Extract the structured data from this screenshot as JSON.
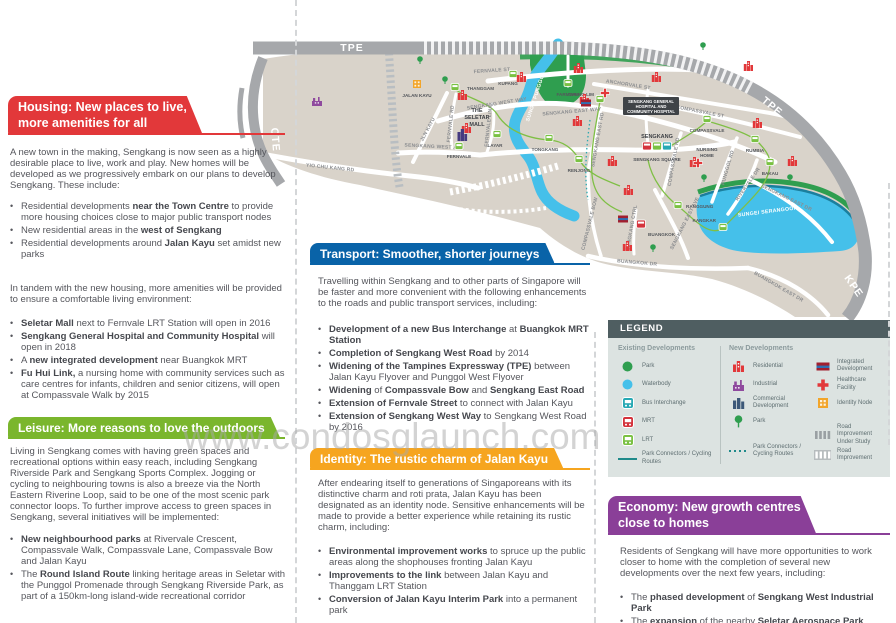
{
  "watermark": "www.condosglaunch.com",
  "sections": {
    "housing": {
      "title": "Housing: New places to live,\nmore amenities for all",
      "intro": "A new town in the making, Sengkang is now seen as a highly desirable place to live, work and play. New homes will be developed as we progressively embark on our plans to develop Sengkang. These include:",
      "bullets1": [
        [
          {
            "t": "Residential developments ",
            "b": false
          },
          {
            "t": "near the Town Centre",
            "b": true
          },
          {
            "t": " to provide more housing choices close to major public transport nodes",
            "b": false
          }
        ],
        [
          {
            "t": "New residential areas in the ",
            "b": false
          },
          {
            "t": "west of Sengkang",
            "b": true
          }
        ],
        [
          {
            "t": "Residential developments around ",
            "b": false
          },
          {
            "t": "Jalan Kayu",
            "b": true
          },
          {
            "t": " set amidst new parks",
            "b": false
          }
        ]
      ],
      "para2": "In tandem with the new housing, more amenities will be provided to ensure a comfortable living environment:",
      "bullets2": [
        [
          {
            "t": "Seletar Mall",
            "b": true
          },
          {
            "t": " next to Fernvale LRT Station will open in 2016",
            "b": false
          }
        ],
        [
          {
            "t": "Sengkang General Hospital and Community Hospital",
            "b": true
          },
          {
            "t": " will open in 2018",
            "b": false
          }
        ],
        [
          {
            "t": "A ",
            "b": false
          },
          {
            "t": "new integrated development",
            "b": true
          },
          {
            "t": " near Buangkok MRT",
            "b": false
          }
        ],
        [
          {
            "t": "Fu Hui Link,",
            "b": true
          },
          {
            "t": " a nursing home with community services such as care centres for infants, children and senior citizens, will open at Compassvale Walk by 2015",
            "b": false
          }
        ]
      ]
    },
    "leisure": {
      "title": "Leisure: More reasons to love the outdoors",
      "intro": "Living in Sengkang comes with having green spaces and recreational options within easy reach, including Sengkang Riverside Park and Sengkang Sports Complex. Jogging or cycling to neighbouring towns is also a breeze via the North Eastern Riverine Loop, said to be one of the most scenic park connector loops. To further improve access to green spaces in Sengkang, several initiatives will be implemented:",
      "bullets": [
        [
          {
            "t": "New neighbourhood parks",
            "b": true
          },
          {
            "t": " at Rivervale Crescent, Compassvale Walk, Compassvale Lane, Compassvale Bow and Jalan Kayu",
            "b": false
          }
        ],
        [
          {
            "t": "The ",
            "b": false
          },
          {
            "t": "Round Island Route",
            "b": true
          },
          {
            "t": " linking heritage areas in Seletar with the Punggol Promenade through Sengkang Riverside Park, as part of a 150km-long island-wide recreational corridor",
            "b": false
          }
        ]
      ]
    },
    "transport": {
      "title": "Transport: Smoother, shorter journeys",
      "intro": "Travelling within Sengkang and to other parts of Singapore will be faster and more convenient with the following enhancements to the roads and public transport services, including:",
      "bullets": [
        [
          {
            "t": "Development of a new Bus Interchange",
            "b": true
          },
          {
            "t": " at ",
            "b": false
          },
          {
            "t": "Buangkok MRT Station",
            "b": true
          }
        ],
        [
          {
            "t": "Completion of Sengkang West Road",
            "b": true
          },
          {
            "t": " by 2014",
            "b": false
          }
        ],
        [
          {
            "t": "Widening of the Tampines Expressway (TPE)",
            "b": true
          },
          {
            "t": " between Jalan Kayu Flyover and Punggol West Flyover",
            "b": false
          }
        ],
        [
          {
            "t": "Widening",
            "b": true
          },
          {
            "t": " of ",
            "b": false
          },
          {
            "t": "Compassvale Bow",
            "b": true
          },
          {
            "t": " and ",
            "b": false
          },
          {
            "t": "Sengkang East Road",
            "b": true
          }
        ],
        [
          {
            "t": "Extension of Fernvale Street",
            "b": true
          },
          {
            "t": " to connect with Jalan Kayu",
            "b": false
          }
        ],
        [
          {
            "t": "Extension of Sengkang West Way",
            "b": true
          },
          {
            "t": " to Sengkang West Road by 2016",
            "b": false
          }
        ]
      ]
    },
    "identity": {
      "title": "Identity: The rustic charm of Jalan Kayu",
      "intro": "After endearing itself to generations of Singaporeans with its distinctive charm and roti prata, Jalan Kayu has been designated as an identity node. Sensitive enhancements will be made to provide a better experience while retaining its rustic charm, including:",
      "bullets": [
        [
          {
            "t": "Environmental improvement works",
            "b": true
          },
          {
            "t": " to spruce up the public areas along the shophouses fronting Jalan Kayu",
            "b": false
          }
        ],
        [
          {
            "t": "Improvements to the link",
            "b": true
          },
          {
            "t": " between Jalan Kayu and Thanggam LRT Station",
            "b": false
          }
        ],
        [
          {
            "t": "Conversion of Jalan Kayu Interim Park",
            "b": true
          },
          {
            "t": " into a permanent park",
            "b": false
          }
        ]
      ]
    },
    "economy": {
      "title": "Economy: New growth centres\nclose to homes",
      "intro": "Residents of Sengkang will have more opportunities to work closer to home with the completion of several new developments over the next few years, including:",
      "bullets": [
        [
          {
            "t": "The ",
            "b": false
          },
          {
            "t": "phased development",
            "b": true
          },
          {
            "t": " of ",
            "b": false
          },
          {
            "t": "Sengkang West Industrial Park",
            "b": true
          }
        ],
        [
          {
            "t": "The ",
            "b": false
          },
          {
            "t": "expansion",
            "b": true
          },
          {
            "t": " of the nearby ",
            "b": false
          },
          {
            "t": "Seletar Aerospace Park",
            "b": true
          }
        ]
      ]
    }
  },
  "legend": {
    "title": "LEGEND",
    "existing_title": "Existing Developments",
    "new_title": "New Developments",
    "existing": [
      {
        "icon": "park-icon",
        "label": "Park"
      },
      {
        "icon": "waterbody-icon",
        "label": "Waterbody"
      },
      {
        "icon": "bus-interchange-icon",
        "label": "Bus Interchange"
      },
      {
        "icon": "mrt-icon",
        "label": "MRT"
      },
      {
        "icon": "lrt-icon",
        "label": "LRT"
      },
      {
        "icon": "line-solid-icon",
        "label": "Park Connectors / Cycling Routes"
      }
    ],
    "new_col1": [
      {
        "icon": "residential-icon",
        "label": "Residential"
      },
      {
        "icon": "industrial-icon",
        "label": "Industrial"
      },
      {
        "icon": "commercial-icon",
        "label": "Commercial Development"
      },
      {
        "icon": "tree-icon",
        "label": "Park"
      },
      {
        "icon": "line-dotted-icon",
        "label": "Park Connectors / Cycling Routes",
        "gap": true
      }
    ],
    "new_col2": [
      {
        "icon": "integrated-icon",
        "label": "Integrated Development"
      },
      {
        "icon": "healthcare-icon",
        "label": "Healthcare Facility"
      },
      {
        "icon": "identity-node-icon",
        "label": "Identity Node"
      },
      {
        "icon": "hatch-gray-icon",
        "label": "Road Improvement Under Study",
        "gap": true
      },
      {
        "icon": "hatch-white-icon",
        "label": "Road Improvement"
      }
    ]
  },
  "map": {
    "labels": [
      {
        "t": "TPE",
        "x": 352,
        "y": 51,
        "r": 0,
        "c": "xw"
      },
      {
        "t": "TPE",
        "x": 770,
        "y": 109,
        "r": 40,
        "c": "xw"
      },
      {
        "t": "CTE",
        "x": 272,
        "y": 140,
        "r": 85,
        "c": "xw"
      },
      {
        "t": "KPE",
        "x": 851,
        "y": 288,
        "r": 55,
        "c": "xw"
      },
      {
        "t": "YIO CHU KANG RD",
        "x": 330,
        "y": 169,
        "r": 6,
        "c": "rd"
      },
      {
        "t": "JLN KAYU",
        "x": 429,
        "y": 130,
        "r": -62,
        "c": "rd"
      },
      {
        "t": "FERNVALE RD",
        "x": 452,
        "y": 124,
        "r": -84,
        "c": "rd"
      },
      {
        "t": "FERNVALE LINK",
        "x": 490,
        "y": 126,
        "r": -84,
        "c": "rd"
      },
      {
        "t": "FERNVALE ST",
        "x": 492,
        "y": 72,
        "r": -4,
        "c": "rd"
      },
      {
        "t": "SENGKANG WEST WAY",
        "x": 497,
        "y": 105,
        "r": -9,
        "c": "rd"
      },
      {
        "t": "SENGKANG WEST AVE",
        "x": 434,
        "y": 148,
        "r": 3,
        "c": "rd"
      },
      {
        "t": "SENGKANG EAST WAY",
        "x": 572,
        "y": 113,
        "r": -5,
        "c": "rd"
      },
      {
        "t": "ANCHORVALE ST",
        "x": 628,
        "y": 86,
        "r": 9,
        "c": "rd"
      },
      {
        "t": "COMPASSVALE ST",
        "x": 700,
        "y": 113,
        "r": 11,
        "c": "rd"
      },
      {
        "t": "SENGKANG EAST RD",
        "x": 599,
        "y": 140,
        "r": -80,
        "c": "rd"
      },
      {
        "t": "COMPASSVALE RD",
        "x": 675,
        "y": 162,
        "r": -80,
        "c": "rd"
      },
      {
        "t": "PUNGGOL RD",
        "x": 729,
        "y": 168,
        "r": -74,
        "c": "rd"
      },
      {
        "t": "RIVERVALE DR",
        "x": 749,
        "y": 185,
        "r": -55,
        "c": "rd"
      },
      {
        "t": "SENGKANG EAST DR",
        "x": 786,
        "y": 199,
        "r": 26,
        "c": "rd"
      },
      {
        "t": "SENGKANG EAST AVE",
        "x": 686,
        "y": 224,
        "r": -63,
        "c": "rd"
      },
      {
        "t": "COMPASSVALE BOW",
        "x": 591,
        "y": 224,
        "r": -76,
        "c": "rd"
      },
      {
        "t": "SENGKANG CTRL",
        "x": 633,
        "y": 228,
        "r": -80,
        "c": "rd"
      },
      {
        "t": "BUANGKOK DR",
        "x": 637,
        "y": 264,
        "r": 5,
        "c": "rd"
      },
      {
        "t": "BUANGKOK EAST DR",
        "x": 778,
        "y": 288,
        "r": 30,
        "c": "rd"
      },
      {
        "t": "SUNGEI PUNGGOL",
        "x": 537,
        "y": 97,
        "r": -72,
        "c": "wt"
      },
      {
        "t": "SUNGEI SERANGOON",
        "x": 768,
        "y": 213,
        "r": -7,
        "c": "wt"
      }
    ],
    "stations": [
      {
        "n": "THANGGAM",
        "x": 455,
        "y": 87,
        "k": "lrt",
        "lx": 467,
        "ly": 90,
        "a": "start"
      },
      {
        "n": "KUPANG",
        "x": 513,
        "y": 74,
        "k": "lrt",
        "lx": 508,
        "ly": 85,
        "a": "middle"
      },
      {
        "n": "FARMWAY",
        "x": 568,
        "y": 83,
        "k": "lrt",
        "lx": 568,
        "ly": 96,
        "a": "middle"
      },
      {
        "n": "FERNVALE",
        "x": 459,
        "y": 146,
        "k": "lrt",
        "lx": 459,
        "ly": 158,
        "a": "middle"
      },
      {
        "n": "LAYAR",
        "x": 497,
        "y": 134,
        "k": "lrt",
        "lx": 495,
        "ly": 147,
        "a": "middle"
      },
      {
        "n": "TONGKANG",
        "x": 549,
        "y": 138,
        "k": "lrt",
        "lx": 545,
        "ly": 151,
        "a": "middle"
      },
      {
        "n": "RENJONG",
        "x": 579,
        "y": 159,
        "k": "lrt",
        "lx": 579,
        "ly": 172,
        "a": "middle"
      },
      {
        "n": "CHENG LIM",
        "x": 600,
        "y": 99,
        "k": "lrt",
        "lx": 594,
        "ly": 96,
        "a": "end"
      },
      {
        "n": "COMPASSVALE",
        "x": 707,
        "y": 119,
        "k": "lrt",
        "lx": 707,
        "ly": 132,
        "a": "middle"
      },
      {
        "n": "RUMBIA",
        "x": 755,
        "y": 139,
        "k": "lrt",
        "lx": 755,
        "ly": 152,
        "a": "middle"
      },
      {
        "n": "BAKAU",
        "x": 770,
        "y": 162,
        "k": "lrt",
        "lx": 770,
        "ly": 175,
        "a": "middle"
      },
      {
        "n": "KANGKAR",
        "x": 723,
        "y": 227,
        "k": "lrt",
        "lx": 716,
        "ly": 222,
        "a": "end"
      },
      {
        "n": "RANGGUNG",
        "x": 678,
        "y": 205,
        "k": "lrt",
        "lx": 686,
        "ly": 208,
        "a": "start"
      },
      {
        "n": "BUANGKOK",
        "x": 641,
        "y": 224,
        "k": "mrt",
        "lx": 648,
        "ly": 236,
        "a": "start"
      }
    ],
    "interchange": {
      "label": "SENGKANG",
      "sub": "SENGKANG SQUARE",
      "x": 657,
      "y": 146
    },
    "buildings": [
      {
        "k": "res",
        "x": 462,
        "y": 96
      },
      {
        "k": "res",
        "x": 521,
        "y": 78
      },
      {
        "k": "res",
        "x": 578,
        "y": 69
      },
      {
        "k": "res",
        "x": 656,
        "y": 78
      },
      {
        "k": "res",
        "x": 748,
        "y": 67
      },
      {
        "k": "res",
        "x": 584,
        "y": 100
      },
      {
        "k": "res",
        "x": 466,
        "y": 129
      },
      {
        "k": "res",
        "x": 577,
        "y": 122
      },
      {
        "k": "res",
        "x": 612,
        "y": 162
      },
      {
        "k": "res",
        "x": 628,
        "y": 191
      },
      {
        "k": "res",
        "x": 694,
        "y": 163
      },
      {
        "k": "res",
        "x": 757,
        "y": 124
      },
      {
        "k": "res",
        "x": 792,
        "y": 162
      },
      {
        "k": "res",
        "x": 627,
        "y": 247
      },
      {
        "k": "ind",
        "x": 317,
        "y": 103
      },
      {
        "k": "mall",
        "x": 462,
        "y": 136
      },
      {
        "k": "integrated",
        "x": 586,
        "y": 103
      },
      {
        "k": "integrated",
        "x": 623,
        "y": 219
      },
      {
        "k": "identity",
        "x": 417,
        "y": 84
      },
      {
        "k": "cross",
        "x": 605,
        "y": 93
      },
      {
        "k": "cross",
        "x": 698,
        "y": 163
      },
      {
        "k": "tree",
        "x": 420,
        "y": 59
      },
      {
        "k": "tree",
        "x": 445,
        "y": 79
      },
      {
        "k": "tree",
        "x": 703,
        "y": 45
      },
      {
        "k": "tree",
        "x": 704,
        "y": 177
      },
      {
        "k": "tree",
        "x": 790,
        "y": 177
      },
      {
        "k": "tree",
        "x": 653,
        "y": 247
      }
    ],
    "pois": [
      {
        "t": "JALAN KAYU",
        "x": 417,
        "y": 97,
        "c": "poi"
      },
      {
        "t": "THE",
        "x": 477,
        "y": 112,
        "c": "poiB"
      },
      {
        "t": "SELETAR",
        "x": 477,
        "y": 119,
        "c": "poiB"
      },
      {
        "t": "MALL",
        "x": 477,
        "y": 126,
        "c": "poiB"
      },
      {
        "t": "NURSING",
        "x": 707,
        "y": 151,
        "c": "poi"
      },
      {
        "t": "HOME",
        "x": 707,
        "y": 157,
        "c": "poi"
      },
      {
        "t": "SENGKANG",
        "x": 657,
        "y": 138,
        "c": "poiB"
      },
      {
        "t": "SENGKANG SQUARE",
        "x": 657,
        "y": 161,
        "c": "poi"
      }
    ],
    "hospital": {
      "lines": [
        "SENGKANG GENERAL",
        "HOSPITAL AND",
        "COMMUNITY HOSPITAL"
      ],
      "x": 651,
      "y": 106
    }
  },
  "colors": {
    "housing": "#e2383a",
    "leisure": "#7ab62d",
    "transport": "#0963a8",
    "identity": "#f6a51f",
    "economy": "#8a3f98",
    "land": "#d9d3ca",
    "water": "#45c0ea",
    "park": "#2f9e4f",
    "expressway": "#a6a8ab",
    "lrt": "#7ac143",
    "mrt": "#d4333c",
    "bus": "#27a9b4"
  }
}
